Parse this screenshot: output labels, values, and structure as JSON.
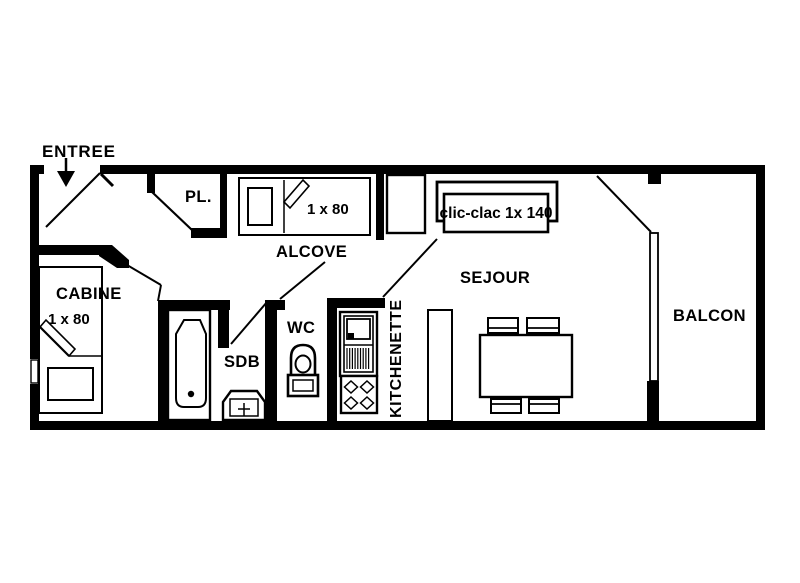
{
  "floorplan": {
    "title": "apartment-floor-plan",
    "colors": {
      "wall": "#000000",
      "background": "#ffffff"
    },
    "labels": {
      "entree": "ENTREE",
      "placard": "PL.",
      "alcove": "ALCOVE",
      "alcove_bed": "1 x 80",
      "clic_clac": "clic-clac 1x 140",
      "sejour": "SEJOUR",
      "balcon": "BALCON",
      "cabine": "CABINE",
      "cabine_bed": "1 x 80",
      "sdb": "SDB",
      "wc": "WC",
      "kitchenette": "KITCHENETTE"
    }
  }
}
